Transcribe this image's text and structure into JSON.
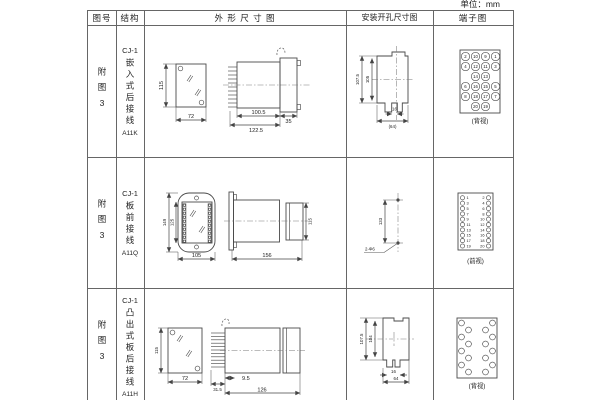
{
  "unit_label": "单位：mm",
  "colors": {
    "line": "#4a4a4a",
    "text": "#222222",
    "background": "#ffffff"
  },
  "table": {
    "headers": [
      "图号",
      "结构",
      "外 形 尺 寸 图",
      "安装开孔尺寸图",
      "端子图"
    ],
    "rows": [
      {
        "figure_no": "附图3",
        "model": "CJ-1",
        "desc": "嵌入式后接线",
        "code": "A11K",
        "outline_dims": {
          "h": "115",
          "w": "72",
          "d1": "100.5",
          "d2": "122.5",
          "d3": "35"
        },
        "mount_dims": {
          "v1": "107.5",
          "v2": "105",
          "h1": "16",
          "h2": "(64)"
        },
        "terminal": {
          "view": "(背视)",
          "numbers": [
            "2",
            "10",
            "9",
            "1",
            "4",
            "12",
            "11",
            "3",
            "14",
            "13",
            "6",
            "16",
            "15",
            "5",
            "8",
            "18",
            "17",
            "7",
            "20",
            "19"
          ]
        }
      },
      {
        "figure_no": "附图3",
        "model": "CJ-1",
        "desc": "板前接线",
        "code": "A11Q",
        "outline_dims": {
          "h1": "149",
          "h2": "125",
          "w": "105",
          "d1": "156",
          "d2": "115"
        },
        "mount_dims": {
          "v1": "133",
          "label": "2-Φ6"
        },
        "terminal": {
          "view": "(前视)",
          "left": [
            "1",
            "3",
            "5",
            "7",
            "9",
            "11",
            "13",
            "15",
            "17",
            "19"
          ],
          "right": [
            "2",
            "4",
            "6",
            "8",
            "10",
            "12",
            "14",
            "16",
            "18",
            "20"
          ]
        }
      },
      {
        "figure_no": "附图3",
        "model": "CJ-1",
        "desc": "凸出式板后接线",
        "code": "A11H",
        "outline_dims": {
          "h": "115",
          "w": "72",
          "d1": "31.5",
          "d2": "9.5",
          "d3": "126"
        },
        "mount_dims": {
          "v1": "107.5",
          "v2": "104",
          "h1": "16",
          "h2": "64"
        },
        "terminal": {
          "view": "(背视)"
        }
      }
    ]
  }
}
